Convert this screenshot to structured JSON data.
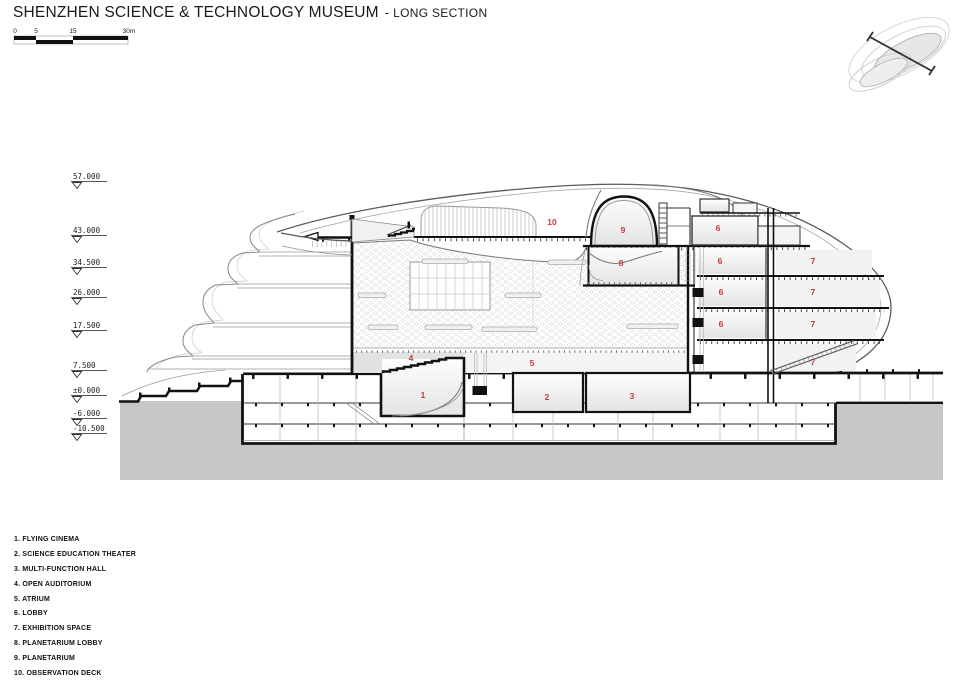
{
  "title": {
    "main": "SHENZHEN SCIENCE & TECHNOLOGY MUSEUM",
    "dash": "-",
    "subtitle": "LONG SECTION"
  },
  "scale_bar": {
    "ticks": [
      "0",
      "5",
      "15",
      "30m"
    ]
  },
  "elevation_marks": [
    "57.000",
    "43.000",
    "34.500",
    "26.000",
    "17.500",
    "7.500",
    "±0.000",
    "-6.000",
    "-10.500"
  ],
  "room_labels": [
    "10",
    "9",
    "6",
    "8",
    "6",
    "7",
    "6",
    "7",
    "6",
    "7",
    "4",
    "5",
    "7",
    "1",
    "2",
    "3"
  ],
  "legend": {
    "items": [
      "1. FLYING CINEMA",
      "2. SCIENCE EDUCATION THEATER",
      "3. MULTI-FUNCTION HALL",
      "4. OPEN AUDITORIUM",
      "5. ATRIUM",
      "6. LOBBY",
      "7. EXHIBITION SPACE",
      "8. PLANETARIUM LOBBY",
      "9. PLANETARIUM",
      "10. OBSERVATION DECK"
    ]
  },
  "colors": {
    "accent_red": "#bf3d38",
    "soil": "#c6c6c6"
  }
}
